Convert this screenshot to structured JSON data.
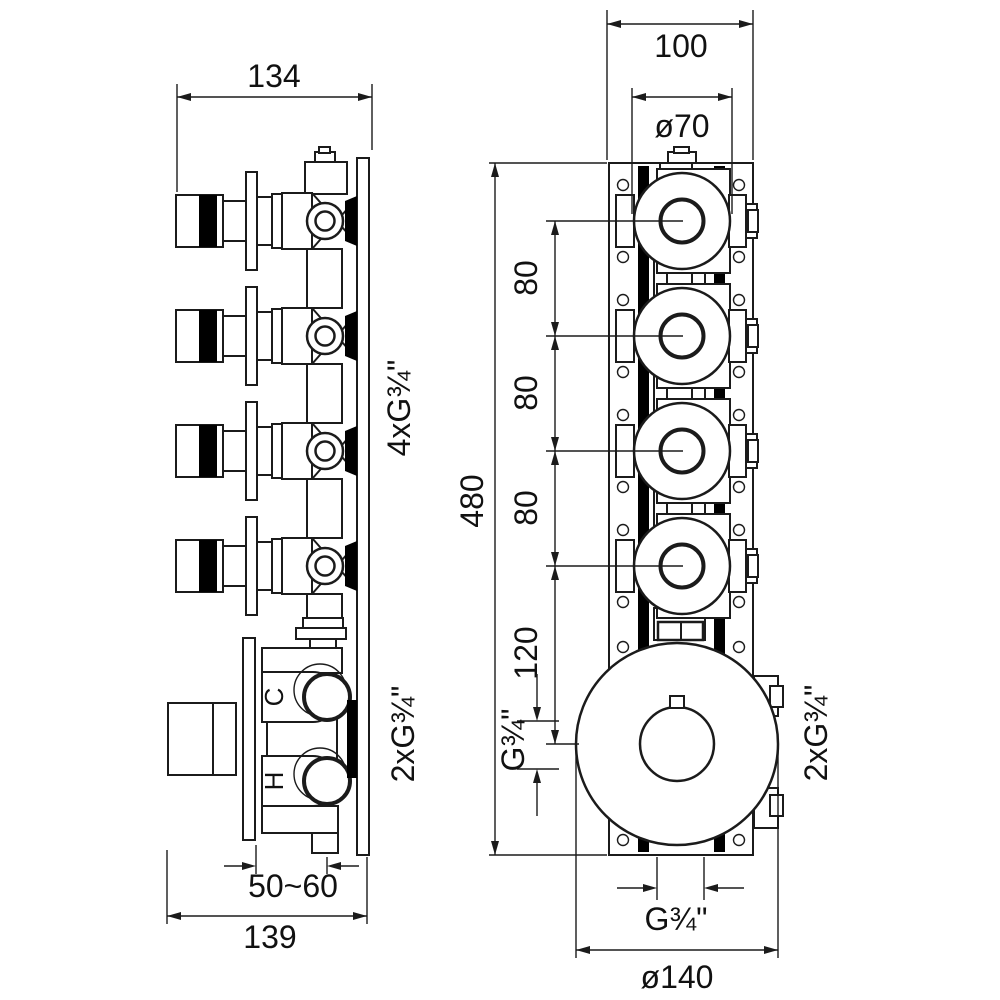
{
  "side_view": {
    "dim_width": "134",
    "dim_recess_depth": "50~60",
    "dim_total_depth": "139",
    "label_outlet_ports": "4xG¾\"",
    "label_supply_ports": "2xG¾\"",
    "label_cold": "C",
    "label_hot": "H"
  },
  "front_view": {
    "dim_body_width": "100",
    "dim_handle_diameter": "ø70",
    "dim_total_height": "480",
    "dim_spacings": [
      "80",
      "80",
      "80",
      "120"
    ],
    "label_side_port": "G¾\"",
    "label_outlet_ports": "2xG¾\"",
    "label_bottom_port": "G¾\"",
    "dim_dial_diameter": "ø140"
  }
}
